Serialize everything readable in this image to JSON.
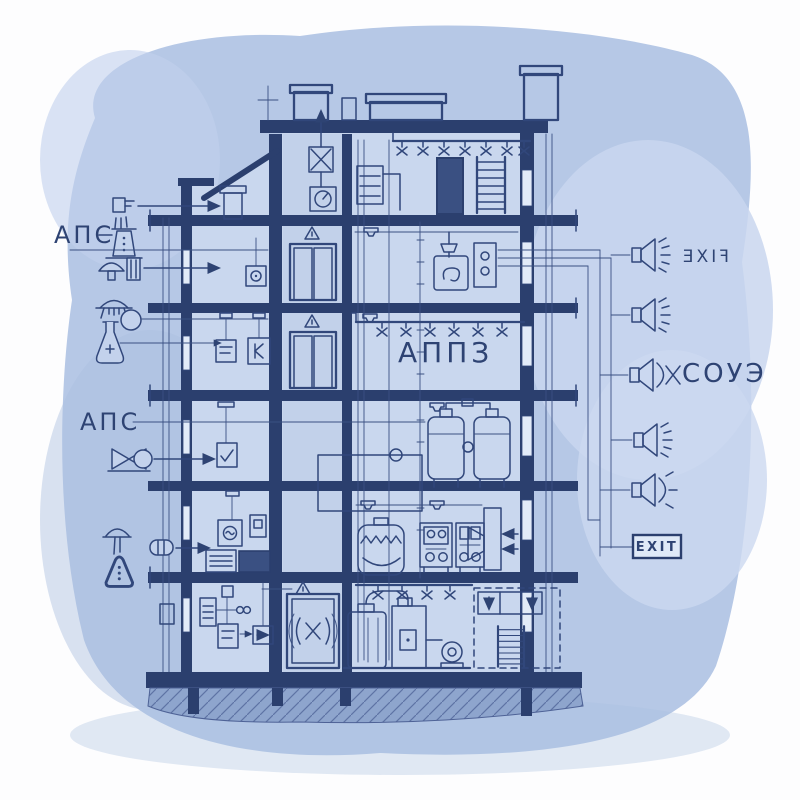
{
  "drawing": {
    "type": "building-section-fire-safety-blueprint",
    "style": "hand-drawn blueprint on watercolor wash"
  },
  "palette": {
    "paper": "#fdfdfe",
    "wash": "#b6c8e6",
    "wash_light": "#c9d6ee",
    "interior": "#c9d7ee",
    "line": "#31477b",
    "structure_dark": "#2b3f6e",
    "window": "#e2ebf8",
    "earth": "#8ea5cd"
  },
  "labels": {
    "fire_alarm_top": "АПС",
    "fire_alarm_mid": "АПС",
    "appz": "АППЗ",
    "soue": "СОУЭ",
    "exit_sign": "EXIT",
    "mirrored_sign": "FIXE"
  },
  "legend_left": {
    "group1_label": "АПС",
    "group1_icons": [
      "wall-sounder",
      "beaker-smoke-detector",
      "mushroom-heat-detector",
      "dome-lamp-detector",
      "flask-detector-with-circle"
    ],
    "group2_label": "АПС",
    "group2_icons": [
      "valve-actuator"
    ],
    "group3_icons": [
      "dome-hydrant",
      "hand-barrel-extinguisher",
      "warning-triangle"
    ]
  },
  "right_system": {
    "speaker_count": 5,
    "speaker_types": [
      "horn-with-rays",
      "horn-with-rays",
      "horn-with-arc-cross",
      "horn-with-rays",
      "horn-with-arc-rays"
    ],
    "exit_badge": "EXIT"
  },
  "building": {
    "floors": 6,
    "features": [
      "roof-vents",
      "sprinkler-lines",
      "elevator-shaft",
      "pressure-tanks",
      "control-panels",
      "pump-room",
      "ladders",
      "foundation-piles"
    ]
  }
}
